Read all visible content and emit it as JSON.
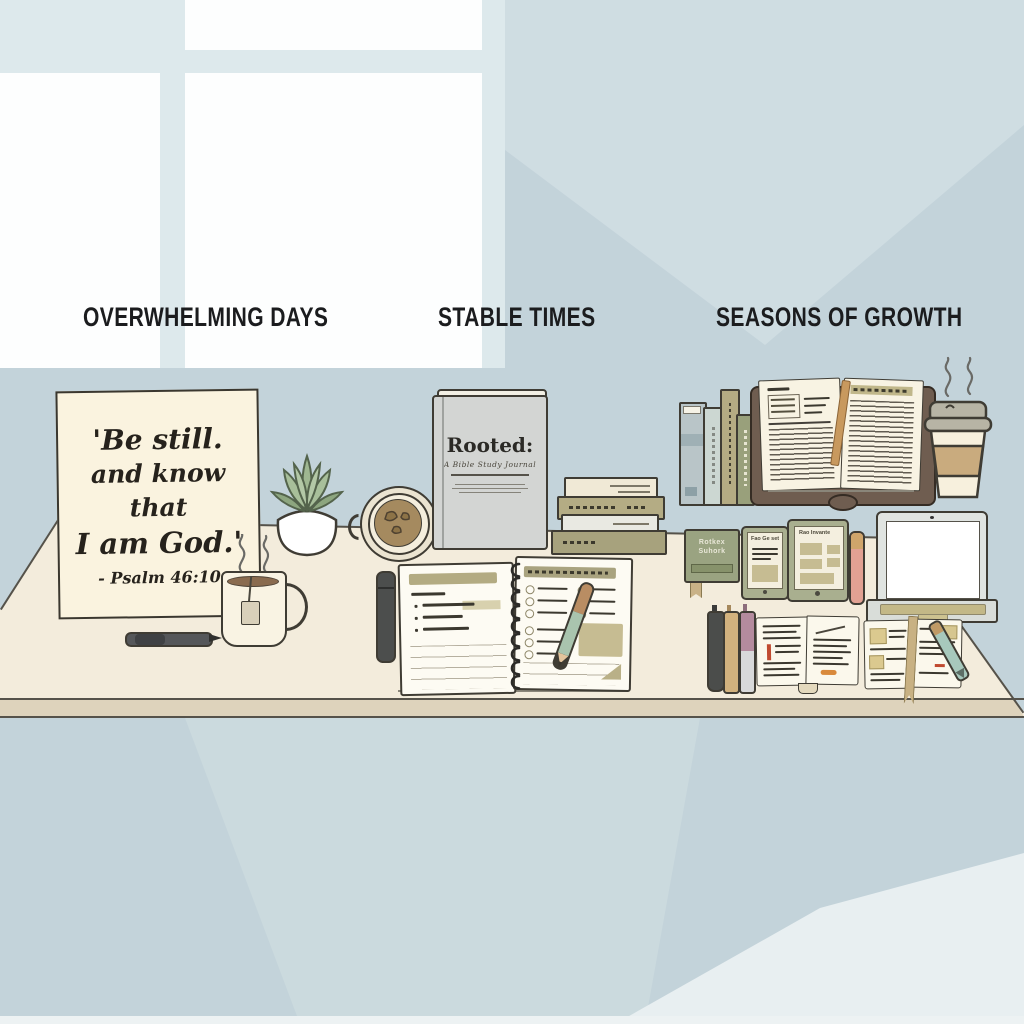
{
  "palette": {
    "wall": "#c3d3da",
    "wall_light": "#cfdde2",
    "wall_dark": "#b9cdd4",
    "window_pane": "#fdfefe",
    "window_mullion": "#dde9ec",
    "desk_top": "#f3ecdc",
    "desk_edge": "#ded3bc",
    "ink_outline": "#3f3c34",
    "khaki": "#b3ab82",
    "olive": "#9aa17b",
    "sage_green": "#a9c4ae",
    "tan": "#c9ab7e",
    "bible_cover": "#6f5d50",
    "accent_red": "#c04a30",
    "accent_orange": "#d98a3c"
  },
  "sections": [
    {
      "label": "OVERWHELMING DAYS"
    },
    {
      "label": "STABLE TIMES"
    },
    {
      "label": "SEASONS OF GROWTH"
    }
  ],
  "quote_card": {
    "line1": "'Be still.",
    "line2": "and know that",
    "line3": "I am God.'",
    "attribution": "- Psalm 46:10"
  },
  "journal_cover": {
    "title": "Rooted:",
    "subtitle": "A Bible Study Journal"
  },
  "mini_book": {
    "line1": "Rotkex",
    "line2": "Suhork"
  },
  "tablets": {
    "small_header": "Fao Ge set",
    "large_header": "Rao Invante"
  }
}
